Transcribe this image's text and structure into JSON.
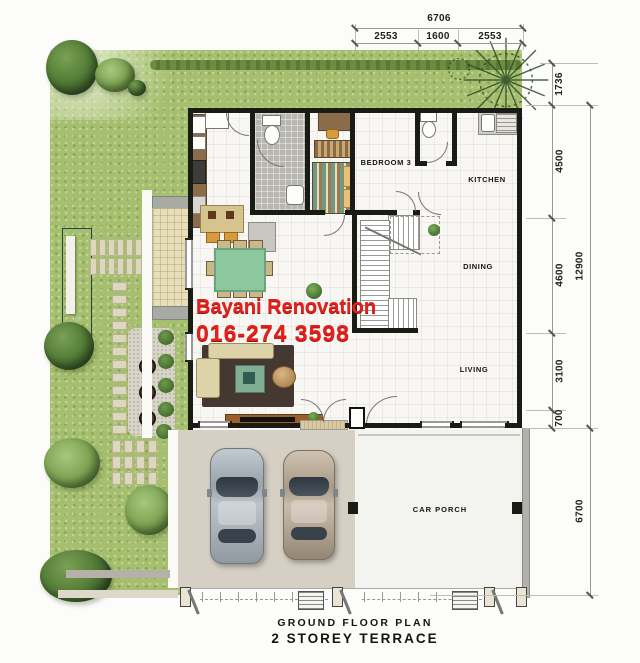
{
  "plan": {
    "watermark": {
      "line1": "Bayani Renovation",
      "line2": "016-274 3598",
      "color": "#e5201a"
    },
    "captions": {
      "line1": "GROUND FLOOR PLAN",
      "line2": "2 STOREY TERRACE"
    },
    "rooms": {
      "bedroom3": "BEDROOM 3",
      "kitchen": "KITCHEN",
      "dining": "DINING",
      "living": "LIVING",
      "car_porch": "CAR PORCH"
    },
    "dimensions": {
      "top_overall": "6706",
      "top_segments": [
        "2553",
        "1600",
        "2553"
      ],
      "right_inner": [
        "1736",
        "4500",
        "4600",
        "3100",
        "700"
      ],
      "right_outer": [
        "12900",
        "6700"
      ]
    },
    "colors": {
      "grass": "#a5bf6e",
      "pool": "#35645a",
      "wall": "#1b1b16",
      "driveway": "#d6cfc3"
    }
  }
}
